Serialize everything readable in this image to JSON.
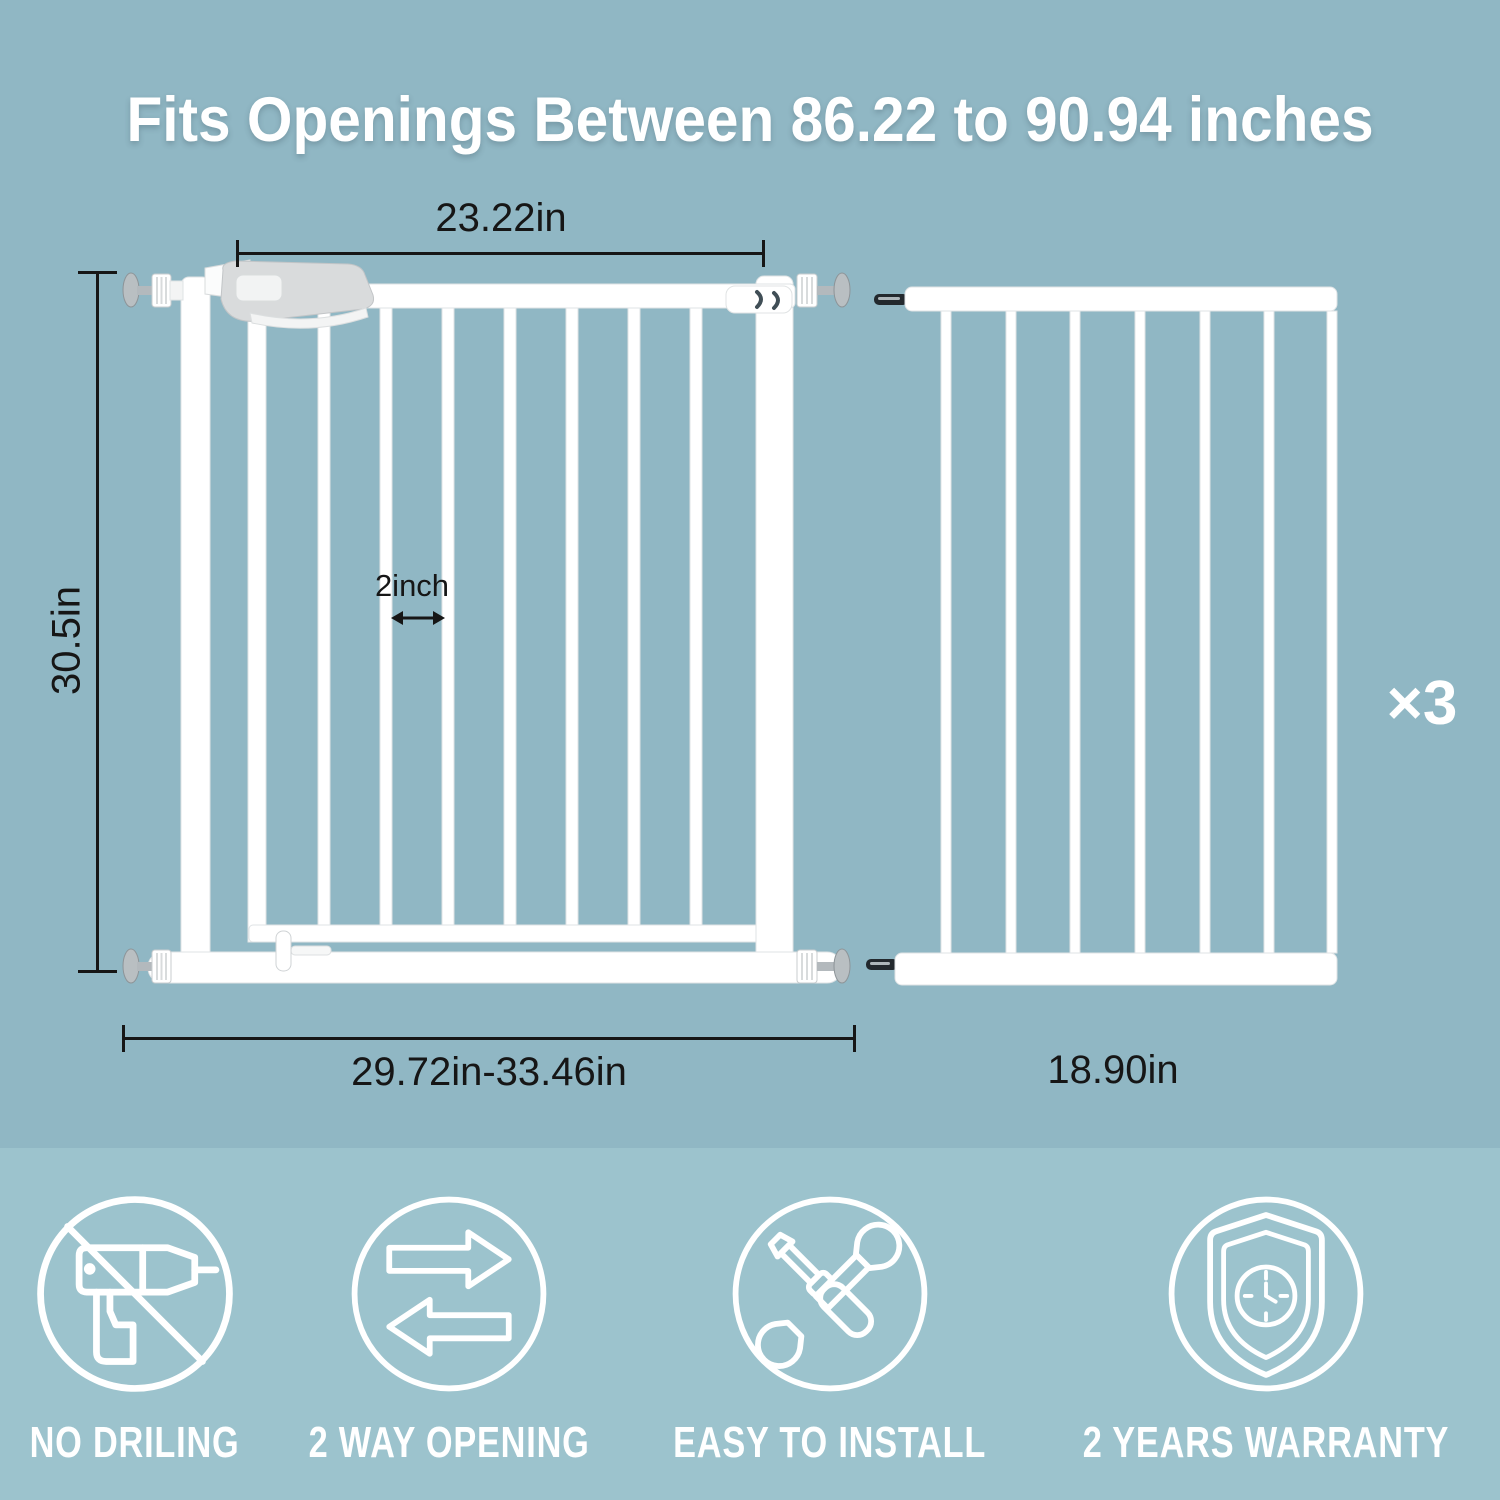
{
  "title": "Fits Openings Between 86.22 to 90.94 inches",
  "colors": {
    "background_top": "#90b7c4",
    "background_bottom": "#9cc3cd",
    "gate_white": "#ffffff",
    "dimension_line": "#161616",
    "feature_foreground": "#ffffff"
  },
  "diagram": {
    "gate": {
      "door_width_label": "23.22in",
      "height_label": "30.5in",
      "bar_gap_label": "2inch",
      "total_width_label": "29.72in-33.46in"
    },
    "extension": {
      "width_label": "18.90in",
      "quantity_label": "×3"
    }
  },
  "features": [
    {
      "icon": "no-drilling-icon",
      "label": "NO DRILING"
    },
    {
      "icon": "two-way-opening-icon",
      "label": "2 WAY OPENING"
    },
    {
      "icon": "easy-to-install-icon",
      "label": "EASY TO INSTALL"
    },
    {
      "icon": "warranty-icon",
      "label": "2 YEARS WARRANTY"
    }
  ]
}
